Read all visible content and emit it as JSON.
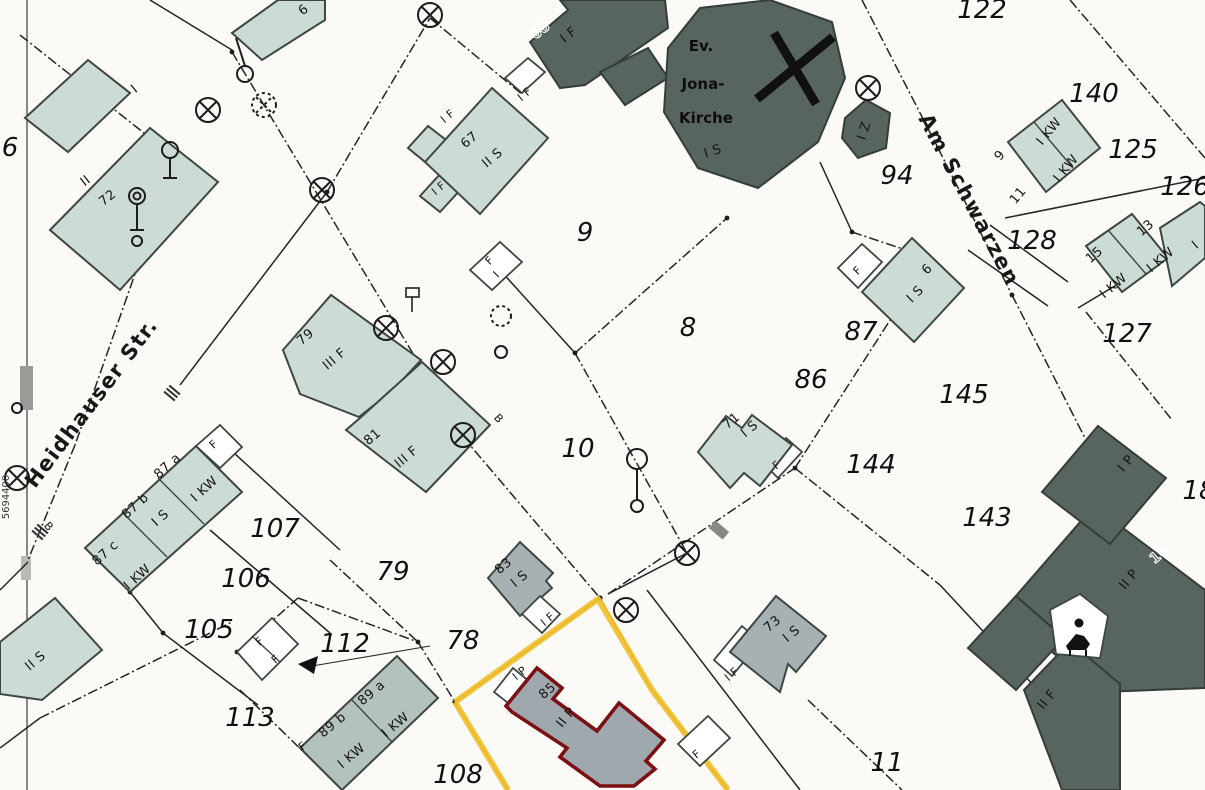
{
  "map_type": "cadastral-parcel-map",
  "colors": {
    "building_light": "#cddbd5",
    "building_mid": "#a7b0b3",
    "building_dark": "#57655e",
    "selected_building_outline": "#7c1012",
    "highlight_parcel_outline": "#f2c12e",
    "boundary_line": "#242424",
    "background": "#fbfaf6"
  },
  "icons": [
    {
      "id": "church-cross",
      "name": "church-cross-icon"
    },
    {
      "id": "survey-point",
      "name": "circle-cross-icon"
    },
    {
      "id": "lamp",
      "name": "lamp-post-icon"
    },
    {
      "id": "arrow",
      "name": "direction-arrow-icon"
    },
    {
      "id": "figure",
      "name": "monument-icon"
    }
  ],
  "labels": [
    {
      "id": "p122",
      "text": "122",
      "x": 982,
      "y": 18,
      "rot": 0,
      "cls": "pn"
    },
    {
      "id": "p140",
      "text": "140",
      "x": 1094,
      "y": 102,
      "rot": 0,
      "cls": "pn"
    },
    {
      "id": "p125",
      "text": "125",
      "x": 1133,
      "y": 158,
      "rot": 0,
      "cls": "pn"
    },
    {
      "id": "p126",
      "text": "126",
      "x": 1185,
      "y": 195,
      "rot": 0,
      "cls": "pn"
    },
    {
      "id": "p128",
      "text": "128",
      "x": 1032,
      "y": 249,
      "rot": 0,
      "cls": "pn"
    },
    {
      "id": "p127",
      "text": "127",
      "x": 1127,
      "y": 342,
      "rot": 0,
      "cls": "pn"
    },
    {
      "id": "p94",
      "text": "94",
      "x": 897,
      "y": 184,
      "rot": 0,
      "cls": "pn"
    },
    {
      "id": "p9",
      "text": "9",
      "x": 585,
      "y": 241,
      "rot": 0,
      "cls": "pn"
    },
    {
      "id": "p8",
      "text": "8",
      "x": 688,
      "y": 336,
      "rot": 0,
      "cls": "pn"
    },
    {
      "id": "p86",
      "text": "86",
      "x": 811,
      "y": 388,
      "rot": 0,
      "cls": "pn"
    },
    {
      "id": "p87",
      "text": "87",
      "x": 861,
      "y": 340,
      "rot": 0,
      "cls": "pn"
    },
    {
      "id": "p145",
      "text": "145",
      "x": 964,
      "y": 403,
      "rot": 0,
      "cls": "pn"
    },
    {
      "id": "p144",
      "text": "144",
      "x": 871,
      "y": 473,
      "rot": 0,
      "cls": "pn"
    },
    {
      "id": "p143",
      "text": "143",
      "x": 987,
      "y": 526,
      "rot": 0,
      "cls": "pn"
    },
    {
      "id": "p10",
      "text": "10",
      "x": 578,
      "y": 457,
      "rot": 0,
      "cls": "pn"
    },
    {
      "id": "p107",
      "text": "107",
      "x": 275,
      "y": 537,
      "rot": 0,
      "cls": "pn"
    },
    {
      "id": "p106",
      "text": "106",
      "x": 246,
      "y": 587,
      "rot": 0,
      "cls": "pn"
    },
    {
      "id": "p105",
      "text": "105",
      "x": 209,
      "y": 638,
      "rot": 0,
      "cls": "pn"
    },
    {
      "id": "p79",
      "text": "79",
      "x": 393,
      "y": 580,
      "rot": 0,
      "cls": "pn"
    },
    {
      "id": "p78",
      "text": "78",
      "x": 463,
      "y": 649,
      "rot": 0,
      "cls": "pn"
    },
    {
      "id": "p112",
      "text": "112",
      "x": 345,
      "y": 652,
      "rot": 0,
      "cls": "pn"
    },
    {
      "id": "p113",
      "text": "113",
      "x": 250,
      "y": 726,
      "rot": 0,
      "cls": "pn"
    },
    {
      "id": "p108",
      "text": "108",
      "x": 458,
      "y": 783,
      "rot": 0,
      "cls": "pn"
    },
    {
      "id": "p11",
      "text": "11",
      "x": 887,
      "y": 771,
      "rot": 0,
      "cls": "pn"
    },
    {
      "id": "p6-edge",
      "text": "6",
      "x": 10,
      "y": 156,
      "rot": 0,
      "cls": "pn"
    },
    {
      "id": "p18-edge",
      "text": "18",
      "x": 1199,
      "y": 499,
      "rot": 0,
      "cls": "pn"
    },
    {
      "id": "h-I-top",
      "text": "I",
      "x": 137,
      "y": 92,
      "rot": -38,
      "cls": "bl"
    },
    {
      "id": "h72-st",
      "text": "II",
      "x": 88,
      "y": 184,
      "rot": -38,
      "cls": "bl"
    },
    {
      "id": "h72",
      "text": "72",
      "x": 110,
      "y": 201,
      "rot": -38,
      "cls": "bl"
    },
    {
      "id": "h6-top",
      "text": "6",
      "x": 306,
      "y": 13,
      "rot": -38,
      "cls": "bl"
    },
    {
      "id": "h67",
      "text": "67",
      "x": 472,
      "y": 143,
      "rot": -40,
      "cls": "bl"
    },
    {
      "id": "h67-st",
      "text": "II S",
      "x": 495,
      "y": 161,
      "rot": -40,
      "cls": "bl"
    },
    {
      "id": "h67-a1",
      "text": "I F",
      "x": 450,
      "y": 119,
      "rot": -40,
      "cls": "bl-sm"
    },
    {
      "id": "h67-a2",
      "text": "I F",
      "x": 441,
      "y": 191,
      "rot": -40,
      "cls": "bl-sm"
    },
    {
      "id": "h67-gap",
      "text": "I F",
      "x": 527,
      "y": 97,
      "rot": -40,
      "cls": "bl-sm"
    },
    {
      "id": "h68",
      "text": "68",
      "x": 543,
      "y": 34,
      "rot": -38,
      "cls": "outline"
    },
    {
      "id": "h68-st",
      "text": "I F",
      "x": 571,
      "y": 38,
      "rot": -38,
      "cls": "bl"
    },
    {
      "id": "hIZ",
      "text": "I Z",
      "x": 868,
      "y": 132,
      "rot": -72,
      "cls": "bl"
    },
    {
      "id": "h9",
      "text": "9",
      "x": 1003,
      "y": 158,
      "rot": -50,
      "cls": "bl"
    },
    {
      "id": "h9-st",
      "text": "I KW",
      "x": 1052,
      "y": 134,
      "rot": -50,
      "cls": "bl"
    },
    {
      "id": "h11",
      "text": "11",
      "x": 1021,
      "y": 198,
      "rot": -50,
      "cls": "bl"
    },
    {
      "id": "h11-st",
      "text": "I KW",
      "x": 1069,
      "y": 171,
      "rot": -50,
      "cls": "bl"
    },
    {
      "id": "h15",
      "text": "15",
      "x": 1097,
      "y": 258,
      "rot": -40,
      "cls": "bl"
    },
    {
      "id": "h15-st",
      "text": "I KW",
      "x": 1116,
      "y": 289,
      "rot": -40,
      "cls": "bl"
    },
    {
      "id": "h13",
      "text": "13",
      "x": 1148,
      "y": 231,
      "rot": -40,
      "cls": "bl"
    },
    {
      "id": "h13-st",
      "text": "I KW",
      "x": 1163,
      "y": 263,
      "rot": -40,
      "cls": "bl"
    },
    {
      "id": "hI-edge",
      "text": "I",
      "x": 1198,
      "y": 248,
      "rot": -40,
      "cls": "bl"
    },
    {
      "id": "h6c",
      "text": "6",
      "x": 930,
      "y": 272,
      "rot": -45,
      "cls": "bl"
    },
    {
      "id": "h6c-st",
      "text": "I S",
      "x": 918,
      "y": 297,
      "rot": -45,
      "cls": "bl"
    },
    {
      "id": "hF-87p",
      "text": "F",
      "x": 860,
      "y": 273,
      "rot": -45,
      "cls": "bl-sm"
    },
    {
      "id": "h71",
      "text": "71",
      "x": 734,
      "y": 424,
      "rot": -40,
      "cls": "bl"
    },
    {
      "id": "h71-st",
      "text": "I S",
      "x": 752,
      "y": 432,
      "rot": -40,
      "cls": "bl"
    },
    {
      "id": "hF-71",
      "text": "F",
      "x": 779,
      "y": 468,
      "rot": -40,
      "cls": "bl-sm"
    },
    {
      "id": "h79",
      "text": "79",
      "x": 308,
      "y": 340,
      "rot": -40,
      "cls": "bl"
    },
    {
      "id": "h79-st",
      "text": "III F",
      "x": 337,
      "y": 362,
      "rot": -40,
      "cls": "bl"
    },
    {
      "id": "h81",
      "text": "81",
      "x": 375,
      "y": 440,
      "rot": -40,
      "cls": "bl"
    },
    {
      "id": "h81-st",
      "text": "III F",
      "x": 409,
      "y": 460,
      "rot": -40,
      "cls": "bl"
    },
    {
      "id": "h87a",
      "text": "87 a",
      "x": 170,
      "y": 469,
      "rot": -42,
      "cls": "bl"
    },
    {
      "id": "h87a-st",
      "text": "I KW",
      "x": 207,
      "y": 492,
      "rot": -42,
      "cls": "bl"
    },
    {
      "id": "h87b",
      "text": "87 b",
      "x": 138,
      "y": 509,
      "rot": -42,
      "cls": "bl"
    },
    {
      "id": "h87b-st",
      "text": "I S",
      "x": 163,
      "y": 521,
      "rot": -42,
      "cls": "bl"
    },
    {
      "id": "h87c",
      "text": "87 c",
      "x": 108,
      "y": 556,
      "rot": -42,
      "cls": "bl"
    },
    {
      "id": "h87c-st",
      "text": "I KW",
      "x": 140,
      "y": 580,
      "rot": -42,
      "cls": "bl"
    },
    {
      "id": "hF-87row",
      "text": "F",
      "x": 216,
      "y": 447,
      "rot": -42,
      "cls": "bl-sm"
    },
    {
      "id": "hIIS-corner",
      "text": "II S",
      "x": 38,
      "y": 664,
      "rot": -40,
      "cls": "bl"
    },
    {
      "id": "h89b",
      "text": "89 b",
      "x": 335,
      "y": 728,
      "rot": -40,
      "cls": "bl"
    },
    {
      "id": "h89b-st",
      "text": "I KW",
      "x": 354,
      "y": 759,
      "rot": -40,
      "cls": "bl"
    },
    {
      "id": "h89a",
      "text": "89 a",
      "x": 374,
      "y": 696,
      "rot": -40,
      "cls": "bl"
    },
    {
      "id": "h89a-st",
      "text": "I KW",
      "x": 398,
      "y": 728,
      "rot": -40,
      "cls": "bl"
    },
    {
      "id": "hF-89",
      "text": "F",
      "x": 305,
      "y": 749,
      "rot": -40,
      "cls": "bl-sm"
    },
    {
      "id": "hF-112a",
      "text": "F",
      "x": 262,
      "y": 644,
      "rot": -42,
      "cls": "bl-sm"
    },
    {
      "id": "hF-112b",
      "text": "F",
      "x": 278,
      "y": 662,
      "rot": -42,
      "cls": "bl-sm"
    },
    {
      "id": "h83",
      "text": "83",
      "x": 506,
      "y": 569,
      "rot": -40,
      "cls": "bl"
    },
    {
      "id": "h83-st",
      "text": "I S",
      "x": 522,
      "y": 582,
      "rot": -40,
      "cls": "bl"
    },
    {
      "id": "h83-a",
      "text": "I F",
      "x": 550,
      "y": 622,
      "rot": -40,
      "cls": "bl-sm"
    },
    {
      "id": "h85-a",
      "text": "I P",
      "x": 522,
      "y": 676,
      "rot": -40,
      "cls": "bl-sm"
    },
    {
      "id": "h85",
      "text": "85",
      "x": 550,
      "y": 694,
      "rot": -40,
      "cls": "bl"
    },
    {
      "id": "h85-st",
      "text": "II P",
      "x": 569,
      "y": 720,
      "rot": -50,
      "cls": "bl"
    },
    {
      "id": "h73",
      "text": "73",
      "x": 775,
      "y": 627,
      "rot": -40,
      "cls": "bl"
    },
    {
      "id": "h73-st",
      "text": "I S",
      "x": 794,
      "y": 637,
      "rot": -40,
      "cls": "bl"
    },
    {
      "id": "h73-a",
      "text": "I F",
      "x": 734,
      "y": 677,
      "rot": -40,
      "cls": "bl-sm"
    },
    {
      "id": "hF-btm",
      "text": "F",
      "x": 699,
      "y": 757,
      "rot": -40,
      "cls": "bl-sm"
    },
    {
      "id": "hF-top",
      "text": "F",
      "x": 492,
      "y": 263,
      "rot": -45,
      "cls": "bl-sm"
    },
    {
      "id": "hI-topf",
      "text": "I",
      "x": 499,
      "y": 277,
      "rot": -45,
      "cls": "bl-sm"
    },
    {
      "id": "hIP-dark",
      "text": "I P",
      "x": 1129,
      "y": 466,
      "rot": -50,
      "cls": "bl"
    },
    {
      "id": "hIIP-dark",
      "text": "II P",
      "x": 1132,
      "y": 582,
      "rot": -50,
      "cls": "bl"
    },
    {
      "id": "h16",
      "text": "16",
      "x": 1162,
      "y": 558,
      "rot": -40,
      "cls": "outline"
    },
    {
      "id": "hIIF-dark",
      "text": "II F",
      "x": 1050,
      "y": 702,
      "rot": -50,
      "cls": "bl"
    },
    {
      "id": "symB1",
      "text": "B",
      "x": 46,
      "y": 529,
      "rot": 48,
      "cls": "bl-sm"
    },
    {
      "id": "symB2",
      "text": "B",
      "x": 496,
      "y": 421,
      "rot": 48,
      "cls": "bl-sm"
    },
    {
      "id": "street-heidhauser",
      "text": "Heidhauser Str.",
      "x": 97,
      "y": 407,
      "rot": -53,
      "cls": "street"
    },
    {
      "id": "street-am-schwarzen",
      "text": "Am Schwarzen",
      "x": 963,
      "y": 203,
      "rot": 62,
      "cls": "street"
    },
    {
      "id": "church-ev",
      "text": "Ev.",
      "x": 701,
      "y": 51,
      "rot": 0,
      "cls": "church-t"
    },
    {
      "id": "church-jona",
      "text": "Jona-",
      "x": 703,
      "y": 89,
      "rot": 0,
      "cls": "church-t"
    },
    {
      "id": "church-kirche",
      "text": "Kirche",
      "x": 706,
      "y": 123,
      "rot": 0,
      "cls": "church-t"
    },
    {
      "id": "church-st",
      "text": "I S",
      "x": 714,
      "y": 155,
      "rot": -18,
      "cls": "bl"
    },
    {
      "id": "grid-coordinate",
      "text": "5694400",
      "x": 9,
      "y": 497,
      "rot": -90,
      "cls": "coord"
    }
  ]
}
